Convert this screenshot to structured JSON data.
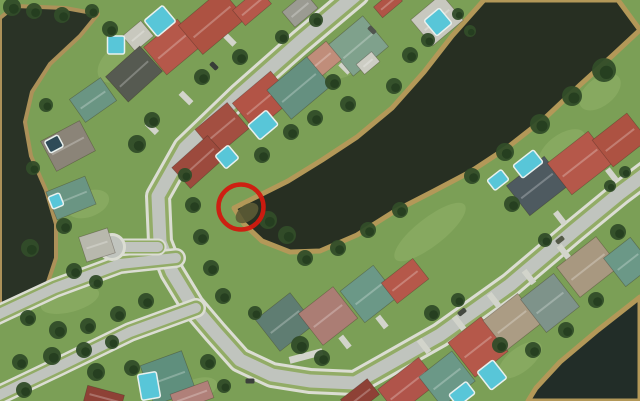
{
  "meta": {
    "view": "satellite-aerial-view",
    "description": "Aerial satellite view of a lakeside residential neighborhood with a red circle marking a spot on the lake shoreline",
    "width": 640,
    "height": 401
  },
  "annotation": {
    "name": "highlight-circle",
    "cx": 241,
    "cy": 207,
    "r": 22.5,
    "stroke": "#d2190f",
    "stroke_width": 4.5
  },
  "palette": {
    "grass": "#7b9f56",
    "lawn": "#93b369",
    "water_dark": "#272f22",
    "pond": "#2a3326",
    "canal": "#222d28",
    "bank": "#b39858",
    "asphalt": "#c0c4be",
    "verge": "#92ac66",
    "sidewalk": "#dbddd3",
    "driveway": "#d2d4cb",
    "pool": "#58c6d8",
    "tree": "#314d29",
    "tree_dark": "#253d1f"
  },
  "scene": {
    "lawn_patches": [
      [
        120,
        62,
        26,
        16,
        -40
      ],
      [
        350,
        56,
        30,
        16,
        -40
      ],
      [
        88,
        204,
        22,
        13,
        -20
      ],
      [
        562,
        150,
        28,
        15,
        -38
      ],
      [
        476,
        332,
        28,
        18,
        -38
      ],
      [
        196,
        390,
        22,
        11,
        -20
      ],
      [
        430,
        232,
        44,
        14,
        -38
      ],
      [
        600,
        92,
        24,
        14,
        -38
      ],
      [
        268,
        76,
        28,
        14,
        -40
      ],
      [
        70,
        300,
        30,
        12,
        -15
      ],
      [
        520,
        360,
        26,
        12,
        -38
      ]
    ],
    "water": [
      {
        "name": "left-pond",
        "fill": "#2a3326",
        "bank": "#ac9159",
        "bank_w": 4,
        "points": [
          [
            15,
            6
          ],
          [
            65,
            8
          ],
          [
            98,
            14
          ],
          [
            80,
            36
          ],
          [
            50,
            64
          ],
          [
            32,
            92
          ],
          [
            25,
            122
          ],
          [
            31,
            156
          ],
          [
            46,
            190
          ],
          [
            56,
            224
          ],
          [
            56,
            258
          ],
          [
            46,
            288
          ],
          [
            26,
            302
          ],
          [
            0,
            308
          ],
          [
            0,
            18
          ]
        ]
      },
      {
        "name": "main-lake",
        "fill": "#272f22",
        "bank": "#b39858",
        "bank_w": 5,
        "points": [
          [
            484,
            0
          ],
          [
            618,
            0
          ],
          [
            640,
            30
          ],
          [
            612,
            56
          ],
          [
            580,
            85
          ],
          [
            545,
            118
          ],
          [
            508,
            147
          ],
          [
            470,
            172
          ],
          [
            432,
            192
          ],
          [
            395,
            211
          ],
          [
            357,
            235
          ],
          [
            320,
            251
          ],
          [
            290,
            252
          ],
          [
            262,
            241
          ],
          [
            244,
            224
          ],
          [
            234,
            208
          ],
          [
            256,
            197
          ],
          [
            288,
            181
          ],
          [
            322,
            160
          ],
          [
            357,
            137
          ],
          [
            392,
            108
          ],
          [
            424,
            72
          ],
          [
            452,
            36
          ]
        ]
      },
      {
        "name": "bottom-right-water",
        "fill": "#222d28",
        "bank": "#b39858",
        "bank_w": 5,
        "points": [
          [
            640,
            297
          ],
          [
            598,
            330
          ],
          [
            560,
            362
          ],
          [
            536,
            388
          ],
          [
            528,
            401
          ],
          [
            640,
            401
          ]
        ]
      }
    ],
    "tip_shallow": {
      "cx": 247,
      "cy": 213,
      "rx": 13,
      "ry": 8,
      "rot": -38,
      "fill": "#5c5b35"
    },
    "roads": [
      {
        "name": "main-loop-road",
        "asphalt": 13,
        "verge": 20,
        "sidewalk": 26,
        "pts": [
          [
            357,
            -6
          ],
          [
            300,
            42
          ],
          [
            240,
            95
          ],
          [
            185,
            148
          ],
          [
            158,
            196
          ],
          [
            160,
            242
          ],
          [
            172,
            272
          ],
          [
            192,
            305
          ],
          [
            215,
            332
          ],
          [
            240,
            360
          ],
          [
            272,
            375
          ],
          [
            310,
            381
          ],
          [
            355,
            383
          ],
          [
            440,
            335
          ],
          [
            510,
            285
          ],
          [
            575,
            230
          ],
          [
            620,
            193
          ],
          [
            648,
            172
          ]
        ]
      },
      {
        "name": "boulevard-upper",
        "asphalt": 10,
        "verge": 15,
        "sidewalk": 20,
        "pts": [
          [
            176,
            258
          ],
          [
            120,
            264
          ],
          [
            55,
            288
          ],
          [
            -5,
            316
          ]
        ]
      },
      {
        "name": "boulevard-lower",
        "asphalt": 10,
        "verge": 15,
        "sidewalk": 20,
        "pts": [
          [
            196,
            308
          ],
          [
            130,
            332
          ],
          [
            60,
            366
          ],
          [
            -5,
            397
          ]
        ]
      },
      {
        "name": "cul-de-sac-stub",
        "asphalt": 10,
        "verge": 13,
        "sidewalk": 17,
        "pts": [
          [
            158,
            247
          ],
          [
            114,
            247
          ]
        ]
      }
    ],
    "culdesac": {
      "cx": 112,
      "cy": 247,
      "r": 11
    },
    "driveways": [
      [
        306,
        356,
        34,
        7,
        -15
      ],
      [
        186,
        98,
        15,
        6,
        45
      ],
      [
        152,
        128,
        14,
        6,
        45
      ],
      [
        230,
        40,
        13,
        6,
        45
      ],
      [
        345,
        68,
        13,
        6,
        45
      ],
      [
        424,
        346,
        16,
        6,
        52
      ],
      [
        459,
        323,
        16,
        6,
        52
      ],
      [
        494,
        300,
        16,
        6,
        52
      ],
      [
        529,
        277,
        16,
        6,
        52
      ],
      [
        564,
        252,
        16,
        6,
        52
      ],
      [
        345,
        342,
        14,
        6,
        52
      ],
      [
        382,
        322,
        14,
        6,
        52
      ],
      [
        560,
        218,
        15,
        6,
        52
      ],
      [
        612,
        175,
        15,
        6,
        52
      ]
    ],
    "houses": [
      [
        138,
        36,
        24,
        20,
        -40,
        "#c8c8be"
      ],
      [
        134,
        74,
        46,
        34,
        -42,
        "#565a51"
      ],
      [
        93,
        100,
        38,
        28,
        -35,
        "#6a9583"
      ],
      [
        68,
        146,
        44,
        34,
        -28,
        "#8b8478"
      ],
      [
        71,
        198,
        42,
        30,
        -22,
        "#6a9583"
      ],
      [
        97,
        245,
        30,
        26,
        -18,
        "#b8b8ad"
      ],
      [
        172,
        47,
        44,
        36,
        -40,
        "#b5584a"
      ],
      [
        212,
        22,
        56,
        38,
        -40,
        "#ad5242"
      ],
      [
        252,
        7,
        34,
        20,
        -40,
        "#b5584a"
      ],
      [
        388,
        4,
        26,
        14,
        -40,
        "#b05446"
      ],
      [
        300,
        10,
        30,
        20,
        -40,
        "#9b9b92"
      ],
      [
        358,
        46,
        46,
        40,
        -40,
        "#7fa18c"
      ],
      [
        368,
        63,
        20,
        13,
        -40,
        "#cdcdc4"
      ],
      [
        320,
        62,
        36,
        24,
        -40,
        "#c08d7a"
      ],
      [
        437,
        20,
        40,
        34,
        -40,
        "#c8c8bf"
      ],
      [
        263,
        101,
        50,
        36,
        -40,
        "#b25446"
      ],
      [
        299,
        88,
        52,
        38,
        -40,
        "#659080"
      ],
      [
        222,
        129,
        42,
        34,
        -40,
        "#a34f41"
      ],
      [
        199,
        162,
        48,
        28,
        -42,
        "#9c4a3d"
      ],
      [
        537,
        186,
        48,
        38,
        -38,
        "#4e5a60"
      ],
      [
        580,
        163,
        52,
        40,
        -38,
        "#b5584a"
      ],
      [
        620,
        140,
        44,
        34,
        -38,
        "#ad5242"
      ],
      [
        285,
        322,
        44,
        40,
        -38,
        "#5f7d72"
      ],
      [
        328,
        316,
        44,
        40,
        -38,
        "#ab7d74"
      ],
      [
        369,
        294,
        42,
        40,
        -38,
        "#6b9887"
      ],
      [
        405,
        281,
        40,
        26,
        -38,
        "#b5584a"
      ],
      [
        408,
        386,
        52,
        32,
        -38,
        "#b0544a"
      ],
      [
        360,
        397,
        34,
        20,
        -38,
        "#8e4136"
      ],
      [
        447,
        379,
        42,
        38,
        -38,
        "#6b9887"
      ],
      [
        478,
        347,
        42,
        44,
        -38,
        "#b5584a"
      ],
      [
        512,
        322,
        44,
        38,
        -38,
        "#ab9c84"
      ],
      [
        550,
        303,
        42,
        42,
        -38,
        "#7e938a"
      ],
      [
        588,
        267,
        50,
        38,
        -38,
        "#a89880"
      ],
      [
        628,
        262,
        34,
        36,
        -38,
        "#6b9887"
      ],
      [
        168,
        378,
        44,
        42,
        -20,
        "#5f8f7d"
      ],
      [
        192,
        396,
        40,
        18,
        -20,
        "#b08079"
      ],
      [
        104,
        398,
        38,
        16,
        15,
        "#8e4136"
      ]
    ],
    "pools": [
      [
        116,
        45,
        17,
        18,
        0,
        "#58c6d8"
      ],
      [
        160,
        21,
        24,
        21,
        -40,
        "#58c6d8"
      ],
      [
        438,
        22,
        20,
        20,
        -40,
        "#58c6d8"
      ],
      [
        263,
        125,
        24,
        19,
        -40,
        "#58c6d8"
      ],
      [
        227,
        157,
        17,
        17,
        -40,
        "#58c6d8"
      ],
      [
        54,
        144,
        15,
        13,
        -28,
        "#2f4b57"
      ],
      [
        56,
        201,
        12,
        13,
        -22,
        "#58c6d8"
      ],
      [
        528,
        164,
        26,
        16,
        -38,
        "#58c6d8"
      ],
      [
        498,
        180,
        18,
        13,
        -38,
        "#58c6d8"
      ],
      [
        462,
        394,
        22,
        15,
        -38,
        "#58c6d8"
      ],
      [
        492,
        375,
        20,
        23,
        -38,
        "#58c6d8"
      ],
      [
        149,
        386,
        19,
        26,
        -10,
        "#58c6d8"
      ]
    ],
    "trees": [
      [
        12,
        7,
        9
      ],
      [
        34,
        11,
        8
      ],
      [
        62,
        15,
        8
      ],
      [
        92,
        11,
        7
      ],
      [
        110,
        29,
        8
      ],
      [
        46,
        105,
        7
      ],
      [
        33,
        168,
        7
      ],
      [
        64,
        226,
        8
      ],
      [
        30,
        248,
        9
      ],
      [
        74,
        271,
        8
      ],
      [
        96,
        282,
        7
      ],
      [
        152,
        120,
        8
      ],
      [
        137,
        144,
        9
      ],
      [
        202,
        77,
        8
      ],
      [
        240,
        57,
        8
      ],
      [
        282,
        37,
        7
      ],
      [
        316,
        20,
        7
      ],
      [
        333,
        82,
        8
      ],
      [
        348,
        104,
        8
      ],
      [
        410,
        55,
        8
      ],
      [
        394,
        86,
        8
      ],
      [
        428,
        40,
        7
      ],
      [
        458,
        14,
        6
      ],
      [
        470,
        31,
        6
      ],
      [
        262,
        155,
        8
      ],
      [
        291,
        132,
        8
      ],
      [
        315,
        118,
        8
      ],
      [
        185,
        175,
        7
      ],
      [
        193,
        205,
        8
      ],
      [
        201,
        237,
        8
      ],
      [
        211,
        268,
        8
      ],
      [
        223,
        296,
        8
      ],
      [
        268,
        220,
        9
      ],
      [
        287,
        235,
        9
      ],
      [
        305,
        258,
        8
      ],
      [
        338,
        248,
        8
      ],
      [
        368,
        230,
        8
      ],
      [
        400,
        210,
        8
      ],
      [
        604,
        70,
        12
      ],
      [
        572,
        96,
        10
      ],
      [
        540,
        124,
        10
      ],
      [
        505,
        152,
        9
      ],
      [
        472,
        176,
        8
      ],
      [
        512,
        204,
        8
      ],
      [
        545,
        240,
        7
      ],
      [
        610,
        186,
        6
      ],
      [
        625,
        172,
        6
      ],
      [
        432,
        313,
        8
      ],
      [
        458,
        300,
        7
      ],
      [
        500,
        345,
        8
      ],
      [
        533,
        350,
        8
      ],
      [
        566,
        330,
        8
      ],
      [
        596,
        300,
        8
      ],
      [
        618,
        232,
        8
      ],
      [
        255,
        313,
        7
      ],
      [
        300,
        345,
        9
      ],
      [
        322,
        358,
        8
      ],
      [
        28,
        318,
        8
      ],
      [
        58,
        330,
        9
      ],
      [
        88,
        326,
        8
      ],
      [
        118,
        314,
        8
      ],
      [
        146,
        301,
        8
      ],
      [
        20,
        362,
        8
      ],
      [
        52,
        356,
        9
      ],
      [
        84,
        350,
        8
      ],
      [
        112,
        342,
        7
      ],
      [
        208,
        362,
        8
      ],
      [
        132,
        368,
        8
      ],
      [
        96,
        372,
        9
      ],
      [
        24,
        390,
        8
      ],
      [
        224,
        386,
        7
      ]
    ],
    "cars": [
      [
        250,
        381,
        0,
        "#3c413b"
      ],
      [
        462,
        312,
        -38,
        "#454a42"
      ],
      [
        560,
        240,
        -38,
        "#545948"
      ],
      [
        214,
        66,
        45,
        "#383d38"
      ],
      [
        372,
        30,
        45,
        "#50554e"
      ]
    ]
  }
}
